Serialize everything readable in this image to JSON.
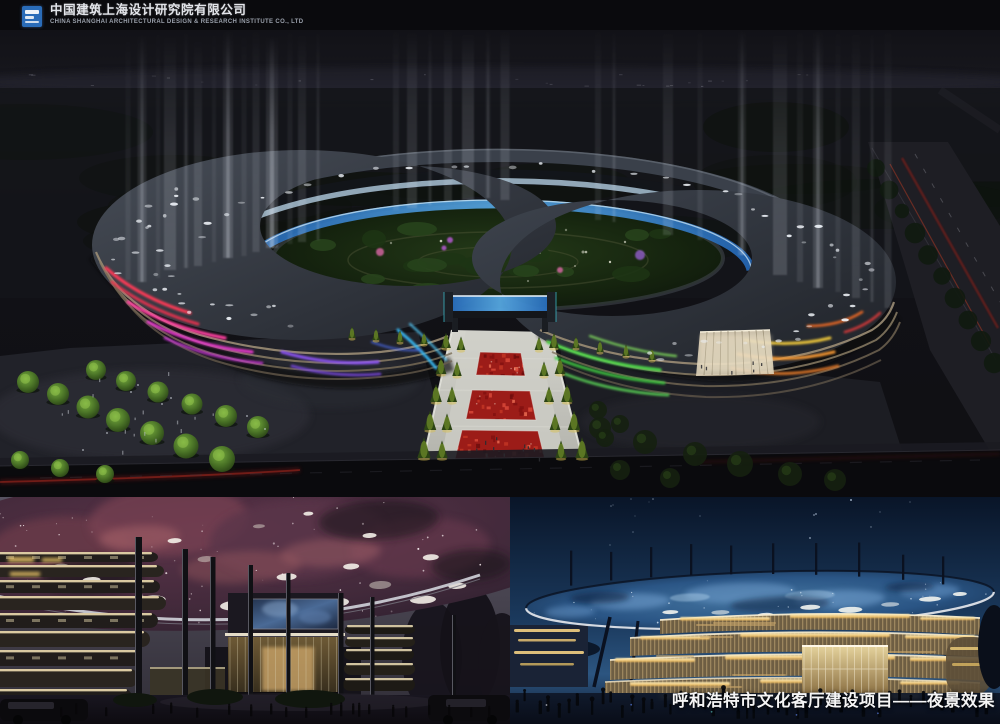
{
  "header": {
    "company_name_cn": "中国建筑上海设计研究院有限公司",
    "company_name_en": "CHINA SHANGHAI ARCHITECTURAL DESIGN & RESEARCH INSTITUTE CO., LTD",
    "logo_name": "csadi-blue-square-logo"
  },
  "caption": {
    "text": "呼和浩特市文化客厅建设项目——夜景效果"
  },
  "renders": {
    "aerial": {
      "name": "aerial-ring-building-night-render"
    },
    "canopy": {
      "name": "plaza-nebula-canopy-night-render"
    },
    "facade": {
      "name": "blue-dome-facade-night-render"
    }
  },
  "colors": {
    "header_bg": "#0a0a0d",
    "logo_blue": "#2a6cb8",
    "caption_white": "#f5f5f5",
    "facade_red": "#ff3b56",
    "facade_pink": "#ff3fa0",
    "facade_magenta": "#e238c8",
    "facade_purple": "#8a52f0",
    "facade_cyan": "#38b6f0",
    "facade_green": "#4ed848",
    "facade_yellow": "#e8c23a",
    "facade_orange": "#f09433",
    "glass_blue": "#4a9ad8",
    "gold_light": "#f3cf82",
    "nebula_pink": "#c67878",
    "dome_blue": "#3f6f9f",
    "night_sky_navy": "#0a1830",
    "red_carpet": "#9c1c18"
  }
}
